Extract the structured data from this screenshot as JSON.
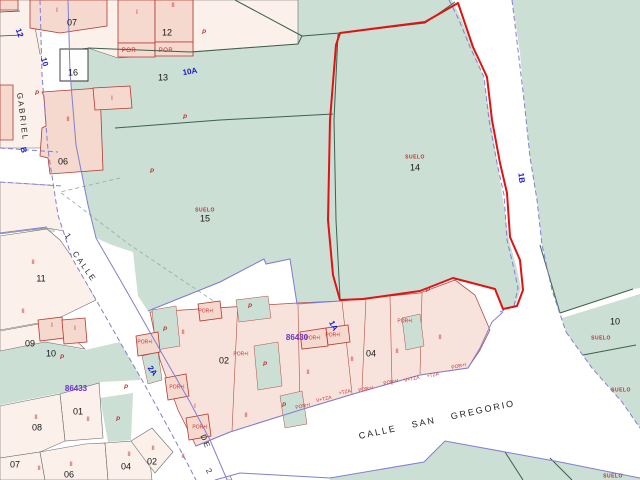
{
  "map": {
    "kind": "cadastral-parcel-map",
    "colors": {
      "rural_green": "#cbdfd4",
      "building_pink": "#f5d8ce",
      "block_pink": "#f8e3dc",
      "parcel_cream": "#fbf0ea",
      "road_white": "#ffffff",
      "boundary_dark_green": "#3f604e",
      "road_edge_violet": "#8080d0",
      "building_outline_red": "#b03a30",
      "highlight_outline_red": "#e01212",
      "text_black": "#161616",
      "text_blue": "#1a1acc",
      "text_red": "#c03030",
      "text_purple": "#6a35c8"
    },
    "highlighted_parcel": {
      "label": "SUELO",
      "number": "14"
    },
    "labels": [
      {
        "text": "GABRIEL",
        "x": 22,
        "y": 117,
        "rot": 83,
        "cls": "street"
      },
      {
        "text": "CALLE",
        "x": 84,
        "y": 267,
        "rot": 55,
        "cls": "street"
      },
      {
        "text": "CALLE SAN GREGORIO",
        "x": 437,
        "y": 420,
        "rot": -12,
        "cls": "street-lg"
      },
      {
        "text": "1",
        "x": 68,
        "y": 237,
        "rot": 55,
        "cls": "street"
      },
      {
        "text": "DE",
        "x": 205,
        "y": 442,
        "rot": 68,
        "cls": "street"
      },
      {
        "text": "2",
        "x": 209,
        "y": 472,
        "rot": 60,
        "cls": "street"
      },
      {
        "text": "12",
        "x": 19,
        "y": 33,
        "rot": 70,
        "cls": "roadcode"
      },
      {
        "text": "10",
        "x": 44,
        "y": 62,
        "rot": 75,
        "cls": "roadcode"
      },
      {
        "text": "B",
        "x": 23,
        "y": 150,
        "rot": 78,
        "cls": "roadcode"
      },
      {
        "text": "10A",
        "x": 190,
        "y": 72,
        "rot": -10,
        "cls": "roadcode"
      },
      {
        "text": "1B",
        "x": 521,
        "y": 178,
        "rot": 83,
        "cls": "roadcode"
      },
      {
        "text": "2A",
        "x": 152,
        "y": 371,
        "rot": 55,
        "cls": "roadcode"
      },
      {
        "text": "1A",
        "x": 333,
        "y": 326,
        "rot": 62,
        "cls": "roadcode"
      },
      {
        "text": "07",
        "x": 72,
        "y": 23,
        "rot": 0,
        "cls": "parcel"
      },
      {
        "text": "12",
        "x": 167,
        "y": 33,
        "rot": 0,
        "cls": "parcel"
      },
      {
        "text": "16",
        "x": 73,
        "y": 73,
        "rot": 0,
        "cls": "parcel"
      },
      {
        "text": "13",
        "x": 163,
        "y": 78,
        "rot": 0,
        "cls": "parcel"
      },
      {
        "text": "06",
        "x": 63,
        "y": 162,
        "rot": 0,
        "cls": "parcel"
      },
      {
        "text": "15",
        "x": 205,
        "y": 219,
        "rot": 0,
        "cls": "parcel"
      },
      {
        "text": "14",
        "x": 415,
        "y": 168,
        "rot": 0,
        "cls": "parcel"
      },
      {
        "text": "11",
        "x": 41,
        "y": 279,
        "rot": 0,
        "cls": "parcel"
      },
      {
        "text": "09",
        "x": 30,
        "y": 344,
        "rot": 0,
        "cls": "parcel"
      },
      {
        "text": "10",
        "x": 51,
        "y": 354,
        "rot": 0,
        "cls": "parcel"
      },
      {
        "text": "01",
        "x": 78,
        "y": 412,
        "rot": 0,
        "cls": "parcel"
      },
      {
        "text": "08",
        "x": 37,
        "y": 428,
        "rot": 0,
        "cls": "parcel"
      },
      {
        "text": "07",
        "x": 15,
        "y": 465,
        "rot": 0,
        "cls": "parcel"
      },
      {
        "text": "06",
        "x": 69,
        "y": 475,
        "rot": 0,
        "cls": "parcel"
      },
      {
        "text": "04",
        "x": 126,
        "y": 467,
        "rot": 0,
        "cls": "parcel"
      },
      {
        "text": "02",
        "x": 152,
        "y": 462,
        "rot": 0,
        "cls": "parcel"
      },
      {
        "text": "02",
        "x": 224,
        "y": 361,
        "rot": 0,
        "cls": "parcel"
      },
      {
        "text": "04",
        "x": 371,
        "y": 354,
        "rot": 0,
        "cls": "parcel"
      },
      {
        "text": "10",
        "x": 615,
        "y": 322,
        "rot": 0,
        "cls": "parcel"
      },
      {
        "text": "SUELO",
        "x": 205,
        "y": 211,
        "rot": 0,
        "cls": "suelo"
      },
      {
        "text": "SUELO",
        "x": 415,
        "y": 158,
        "rot": 0,
        "cls": "suelo"
      },
      {
        "text": "SUELO",
        "x": 601,
        "y": 339,
        "rot": 0,
        "cls": "suelo"
      },
      {
        "text": "SUELO",
        "x": 621,
        "y": 391,
        "rot": 0,
        "cls": "suelo"
      },
      {
        "text": "SUELO",
        "x": 613,
        "y": 477,
        "rot": 0,
        "cls": "suelo"
      },
      {
        "text": "POR",
        "x": 129,
        "y": 51,
        "rot": 0,
        "cls": "por"
      },
      {
        "text": "POR",
        "x": 166,
        "y": 51,
        "rot": 0,
        "cls": "por"
      },
      {
        "text": "POR+I",
        "x": 145,
        "y": 343,
        "rot": 0,
        "cls": "portiny"
      },
      {
        "text": "POR+I",
        "x": 177,
        "y": 388,
        "rot": 0,
        "cls": "portiny"
      },
      {
        "text": "POR+I",
        "x": 200,
        "y": 428,
        "rot": 0,
        "cls": "portiny"
      },
      {
        "text": "POR+I",
        "x": 206,
        "y": 312,
        "rot": 0,
        "cls": "portiny"
      },
      {
        "text": "POR+I",
        "x": 241,
        "y": 355,
        "rot": 0,
        "cls": "portiny"
      },
      {
        "text": "POR+I",
        "x": 313,
        "y": 339,
        "rot": 0,
        "cls": "portiny"
      },
      {
        "text": "POR+I",
        "x": 333,
        "y": 336,
        "rot": 0,
        "cls": "portiny"
      },
      {
        "text": "POR+I",
        "x": 405,
        "y": 322,
        "rot": 0,
        "cls": "portiny"
      },
      {
        "text": "POR+I",
        "x": 303,
        "y": 407,
        "rot": -12,
        "cls": "portiny"
      },
      {
        "text": "V+TZA",
        "x": 324,
        "y": 400,
        "rot": -12,
        "cls": "portiny"
      },
      {
        "text": "+TZA",
        "x": 345,
        "y": 393,
        "rot": -12,
        "cls": "portiny"
      },
      {
        "text": "POR+I",
        "x": 366,
        "y": 390,
        "rot": -12,
        "cls": "portiny"
      },
      {
        "text": "POR+I",
        "x": 391,
        "y": 383,
        "rot": -12,
        "cls": "portiny"
      },
      {
        "text": "V+TZA",
        "x": 412,
        "y": 380,
        "rot": -12,
        "cls": "portiny"
      },
      {
        "text": "+TZA",
        "x": 433,
        "y": 376,
        "rot": -12,
        "cls": "portiny"
      },
      {
        "text": "POR+I",
        "x": 459,
        "y": 367,
        "rot": -12,
        "cls": "portiny"
      },
      {
        "text": "I",
        "x": 57,
        "y": 11,
        "rot": 0,
        "cls": "roman"
      },
      {
        "text": "I",
        "x": 137,
        "y": 13,
        "rot": 0,
        "cls": "roman"
      },
      {
        "text": "II",
        "x": 173,
        "y": 6,
        "rot": 0,
        "cls": "roman"
      },
      {
        "text": "I",
        "x": 112,
        "y": 99,
        "rot": 0,
        "cls": "roman"
      },
      {
        "text": "II",
        "x": 68,
        "y": 120,
        "rot": 0,
        "cls": "roman"
      },
      {
        "text": "II",
        "x": 33,
        "y": 263,
        "rot": 0,
        "cls": "roman"
      },
      {
        "text": "II",
        "x": 23,
        "y": 312,
        "rot": 0,
        "cls": "roman"
      },
      {
        "text": "I",
        "x": 52,
        "y": 326,
        "rot": 0,
        "cls": "roman"
      },
      {
        "text": "I",
        "x": 75,
        "y": 329,
        "rot": 0,
        "cls": "roman"
      },
      {
        "text": "II",
        "x": 36,
        "y": 418,
        "rot": 0,
        "cls": "roman"
      },
      {
        "text": "II",
        "x": 88,
        "y": 420,
        "rot": 0,
        "cls": "roman"
      },
      {
        "text": "II",
        "x": 39,
        "y": 469,
        "rot": 0,
        "cls": "roman"
      },
      {
        "text": "II",
        "x": 71,
        "y": 465,
        "rot": 0,
        "cls": "roman"
      },
      {
        "text": "II",
        "x": 129,
        "y": 455,
        "rot": 0,
        "cls": "roman"
      },
      {
        "text": "II",
        "x": 153,
        "y": 449,
        "rot": 0,
        "cls": "roman"
      },
      {
        "text": "II",
        "x": 183,
        "y": 333,
        "rot": 0,
        "cls": "roman"
      },
      {
        "text": "II",
        "x": 308,
        "y": 373,
        "rot": 0,
        "cls": "roman"
      },
      {
        "text": "II",
        "x": 352,
        "y": 360,
        "rot": 0,
        "cls": "roman"
      },
      {
        "text": "II",
        "x": 397,
        "y": 352,
        "rot": 0,
        "cls": "roman"
      },
      {
        "text": "II",
        "x": 246,
        "y": 416,
        "rot": 0,
        "cls": "roman"
      },
      {
        "text": "II",
        "x": 440,
        "y": 338,
        "rot": 0,
        "cls": "roman"
      },
      {
        "text": "I",
        "x": 195,
        "y": 407,
        "rot": 0,
        "cls": "roman"
      },
      {
        "text": "II",
        "x": 183,
        "y": 457,
        "rot": 0,
        "cls": "roman"
      },
      {
        "text": "P",
        "x": 204,
        "y": 33,
        "rot": 0,
        "cls": "pmark"
      },
      {
        "text": "P",
        "x": 185,
        "y": 118,
        "rot": 0,
        "cls": "pmark"
      },
      {
        "text": "P",
        "x": 37,
        "y": 94,
        "rot": 0,
        "cls": "pmark"
      },
      {
        "text": "P",
        "x": 152,
        "y": 172,
        "rot": 0,
        "cls": "pmark"
      },
      {
        "text": "P",
        "x": 62,
        "y": 358,
        "rot": 0,
        "cls": "pmark"
      },
      {
        "text": "P",
        "x": 118,
        "y": 420,
        "rot": 0,
        "cls": "pmark"
      },
      {
        "text": "P",
        "x": 126,
        "y": 388,
        "rot": 0,
        "cls": "pmark"
      },
      {
        "text": "P",
        "x": 165,
        "y": 330,
        "rot": 0,
        "cls": "pmark"
      },
      {
        "text": "P",
        "x": 250,
        "y": 307,
        "rot": 0,
        "cls": "pmark"
      },
      {
        "text": "P",
        "x": 265,
        "y": 365,
        "rot": 0,
        "cls": "pmark"
      },
      {
        "text": "P",
        "x": 284,
        "y": 406,
        "rot": 0,
        "cls": "pmark"
      },
      {
        "text": "P",
        "x": 428,
        "y": 291,
        "rot": 0,
        "cls": "pmark"
      },
      {
        "text": "86433",
        "x": 76,
        "y": 389,
        "rot": 0,
        "cls": "block"
      },
      {
        "text": "86430",
        "x": 297,
        "y": 338,
        "rot": 0,
        "cls": "block"
      }
    ]
  }
}
